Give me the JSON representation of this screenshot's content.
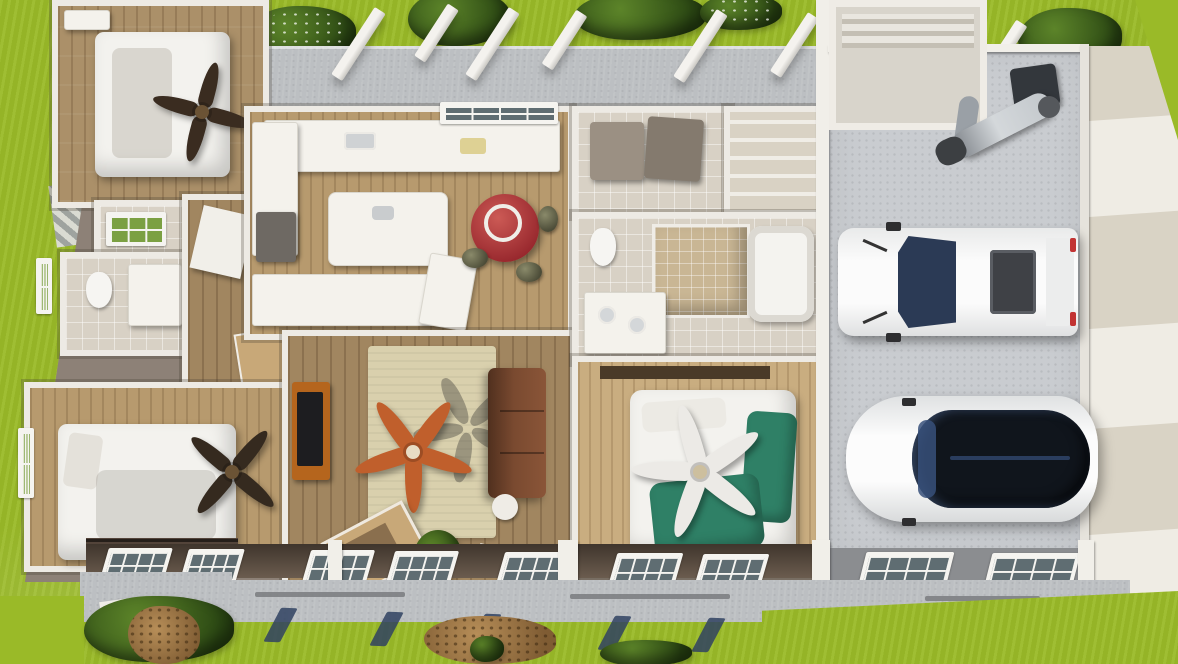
{
  "scene": {
    "kind": "aerial-3d-floorplan-render",
    "palette": {
      "grass": "#9aba28",
      "grass_shadow": "#2c4914",
      "porch_concrete": "#bcbfc2",
      "garage_floor": "#c9ccd0",
      "driveway_beige": "#d9d3c5",
      "driveway_light": "#efece4",
      "wall_white": "#f1efe9",
      "wall_brown_gray": "#8d8177",
      "front_fascia_dark": "#5a4c40",
      "wood_floor": "#b79a6e",
      "wood_floor_master": "#c9ad80",
      "tile": "#d8d1c5",
      "rug_beige": "#d9d0ad",
      "sofa_brown": "#774830",
      "dining_table_red": "#b2383b",
      "bed_linen_white": "#f3f2ee",
      "duvet_teal_green": "#2f8066",
      "fan_orange": "#c05f2c",
      "fan_dark": "#3a2c20",
      "vehicle_white": "#fafafa",
      "glass_navy": "#2b3a55",
      "canopy_black": "#10151c",
      "awning_shadow_blue": "#304262"
    },
    "objects": {
      "bedroom_top_left_bed": "white double bed",
      "bedroom_bottom_left_bed": "white double bed",
      "master_bed": "bed with teal-green and white bedding",
      "kitchen_island": "white kitchen island",
      "dining_table": "round red dining table",
      "sofa": "brown fabric sofa",
      "tv_console": "wood media console with TV",
      "ceiling_fan_living": "orange five-blade ceiling fan",
      "ceiling_fan_master": "white five-blade ceiling fan",
      "washer_dryer": "washer and dryer pair",
      "truck": "white pickup truck",
      "car": "white car with dark glass roof",
      "motorcycle": "parked motorcycle",
      "porch_columns": "white porch columns",
      "front_windows": "white framed front windows"
    },
    "counts": {
      "vehicles": 2,
      "ceiling_fans": 4,
      "beds": 3
    }
  }
}
